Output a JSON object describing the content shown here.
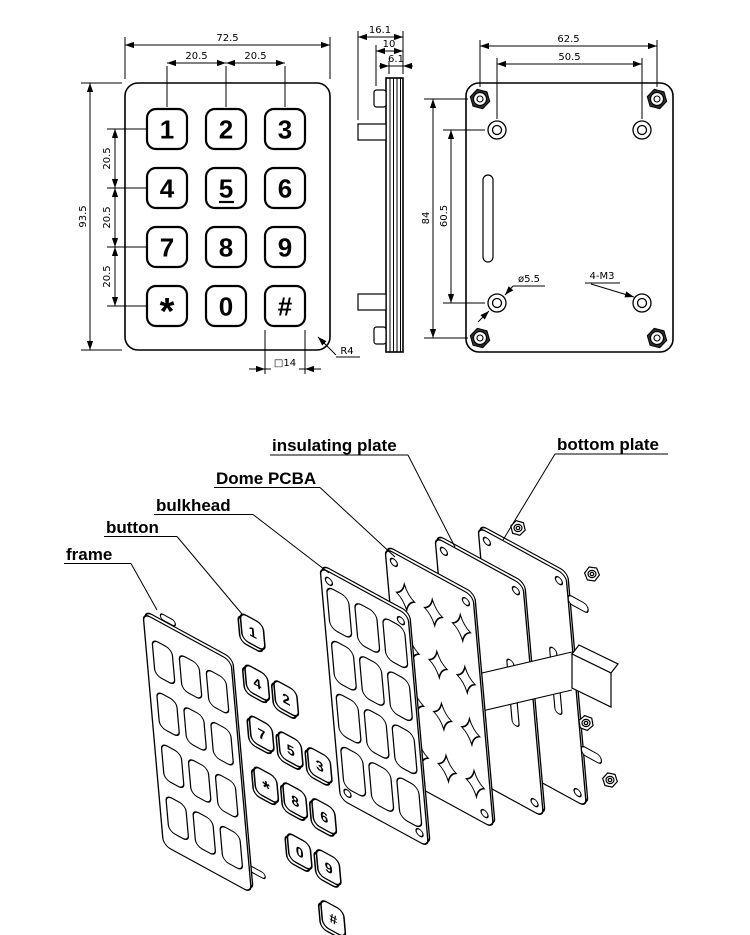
{
  "drawing": {
    "front_view": {
      "keys": [
        "1",
        "2",
        "3",
        "4",
        "5",
        "6",
        "7",
        "8",
        "9",
        "*",
        "0",
        "#"
      ],
      "dims": {
        "overall_width": "72.5",
        "col_pitch_left": "20.5",
        "col_pitch_right": "20.5",
        "overall_height": "93.5",
        "row_pitch_1": "20.5",
        "row_pitch_2": "20.5",
        "row_pitch_3": "20.5",
        "key_size": "□14",
        "corner_radius": "R4"
      }
    },
    "side_view": {
      "dims": {
        "overall_depth": "16.1",
        "body_depth": "10",
        "plate_stack": "6.1"
      }
    },
    "back_view": {
      "dims": {
        "stud_span_h": "62.5",
        "hole_span_h": "50.5",
        "stud_span_v": "84",
        "hole_span_v": "60.5",
        "hole_diameter": "ø5.5",
        "stud_spec": "4-M3"
      }
    },
    "exploded_view": {
      "labels": {
        "frame": "frame",
        "button": "button",
        "bulkhead": "bulkhead",
        "dome_pcba": "Dome PCBA",
        "insulating_plate": "insulating plate",
        "bottom_plate": "bottom plate"
      }
    }
  }
}
